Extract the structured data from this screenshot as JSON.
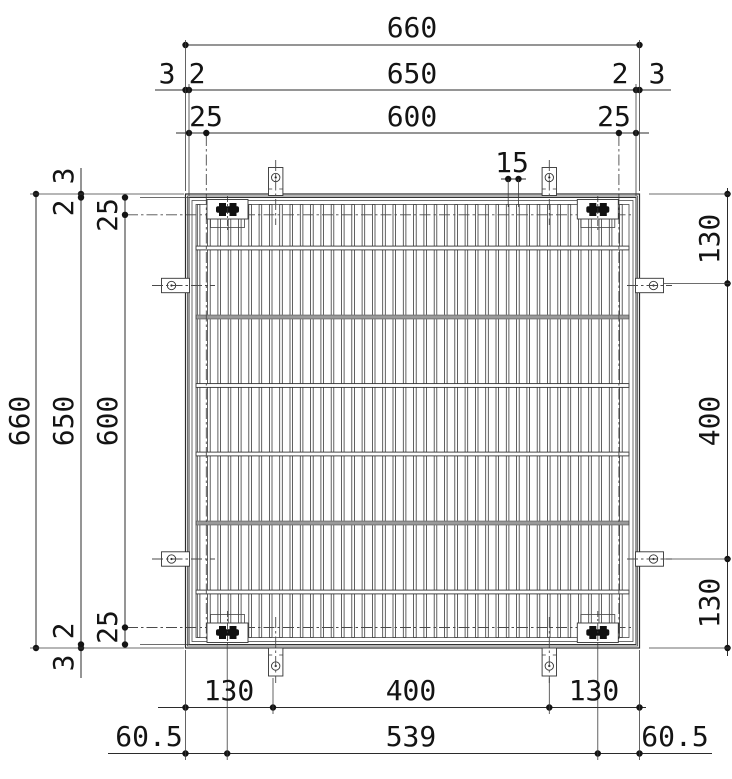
{
  "dims": {
    "top": {
      "overall": "660",
      "frame": "650",
      "opening": "600",
      "left_outer": "3",
      "left_inner": "2",
      "right_inner": "2",
      "right_outer": "3",
      "offset_left": "25",
      "offset_right": "25",
      "bar_pitch": "15"
    },
    "left": {
      "overall": "660",
      "frame": "650",
      "opening": "600",
      "top_outer": "3",
      "top_inner": "2",
      "bottom_inner": "2",
      "bottom_outer": "3",
      "offset_top": "25",
      "offset_bottom": "25"
    },
    "right": {
      "top": "130",
      "middle": "400",
      "bottom": "130"
    },
    "bottom": {
      "left": "130",
      "center": "400",
      "right": "130",
      "anchor_left": "60.5",
      "anchor_span": "539",
      "anchor_right": "60.5"
    }
  },
  "colors": {
    "line": "#2b2b2b",
    "chain": "#4a4a4a",
    "bolt": "#111111",
    "crossbar_gray": "#9a9a9a"
  }
}
